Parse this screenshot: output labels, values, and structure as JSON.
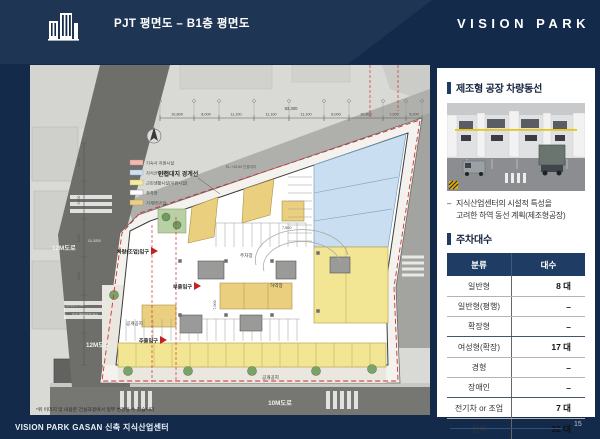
{
  "header": {
    "title": "PJT 평면도 – B1층 평면도",
    "logo": "VISION PARK"
  },
  "colors": {
    "slide_navy": "#132a4b",
    "accent_navy": "#1e3c64",
    "plan_red": "#cf3030",
    "unit_blue": "#c9dff1",
    "unit_yellow": "#f2e695",
    "unit_tan": "#eacf7e"
  },
  "plan": {
    "legend": [
      {
        "label": "기숙사 지원시설",
        "color": "#f5b8ae"
      },
      {
        "label": "지식산업센터",
        "color": "#cfe0f2"
      },
      {
        "label": "근린생활시설(지원시설)",
        "color": "#f5ec9e"
      },
      {
        "label": "주차장",
        "color": "#ffffff"
      },
      {
        "label": "기계/전기실",
        "color": "#eccf84"
      }
    ],
    "dim_total": "83,300",
    "top_dims": [
      "10,800",
      "8,000",
      "11,100",
      "11,100",
      "11,100",
      "8,000",
      "10,800",
      "7,200",
      "5,200"
    ],
    "left_dims": [
      "8,000",
      "8,600",
      "8,600",
      "8,000"
    ],
    "labels": {
      "boundary": "인접대지 경계선",
      "el": "EL.+15.50 인접대지",
      "road12_a": "12M도로",
      "road12_b": "12M도로",
      "road10": "10M도로",
      "gl": "GL-5200",
      "entry_vehicle": "차량(조업)입구",
      "entry_sub": "부출입구",
      "entry_main": "주출입구",
      "open_left": "공개공지",
      "open_bottom": "공개공지",
      "loading": "하역장",
      "parking": "주차장",
      "road_note1": "공개공지 3M",
      "road_note2": "도로 확보구간(2M)",
      "dim7500": "7,500",
      "dim7000": "7,000",
      "note": "*위 이미지 및 내용은 건설과정에서 일부 변경될 수 있습니다"
    }
  },
  "side": {
    "section1_title": "제조형 공장 차량동선",
    "bullet_dash": "–",
    "bullet_line1": "지식산업센터의 시설적 특성을",
    "bullet_line2": "고려한 하역 동선 계획(제조형공장)",
    "section2_title": "주차대수",
    "table": {
      "headers": [
        "분류",
        "대수"
      ],
      "rows": [
        [
          "일반형",
          "8 대"
        ],
        [
          "일반형(평행)",
          "–"
        ],
        [
          "확장형",
          "–"
        ],
        [
          "여성형(확장)",
          "17 대"
        ],
        [
          "경형",
          "–"
        ],
        [
          "장애인",
          "–"
        ],
        [
          "전기차 or 조업",
          "7 대"
        ],
        [
          "합계",
          "32 대"
        ]
      ]
    }
  },
  "footer": {
    "text": "VISION PARK GASAN 신축 지식산업센터",
    "page": "15"
  }
}
